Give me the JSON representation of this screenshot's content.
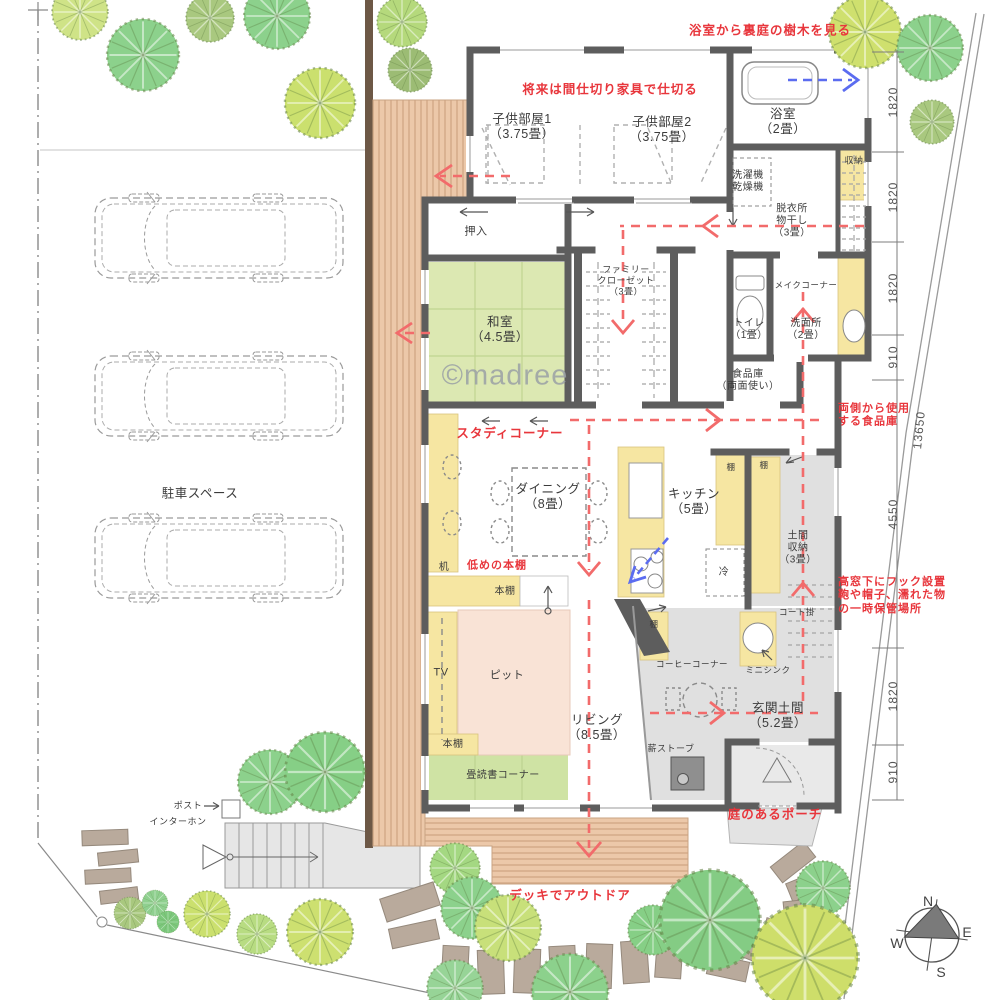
{
  "watermark": "©madree",
  "compass": {
    "n": "N",
    "e": "E",
    "s": "S",
    "w": "W"
  },
  "site": {
    "parking_label": "駐車スペース",
    "post_label": "ポスト",
    "intercom_label": "インターホン"
  },
  "annotations": {
    "bath_view": "浴室から裏庭の樹木を見る",
    "future_partition": "将来は間仕切り家具で仕切る",
    "study_corner": "スタディコーナー",
    "low_bookshelf": "低めの本棚",
    "pantry_both_sides": {
      "line1": "両側から使用",
      "line2": "する食品庫"
    },
    "hooks_note": {
      "line1": "高窓下にフック設置",
      "line2": "鞄や帽子、濡れた物",
      "line3": "の一時保管場所"
    },
    "garden_porch": "庭のあるポーチ",
    "deck_outdoor": "デッキでアウトドア"
  },
  "rooms": {
    "child1": {
      "name": "子供部屋1",
      "size": "（3.75畳）"
    },
    "child2": {
      "name": "子供部屋2",
      "size": "（3.75畳）"
    },
    "bath": {
      "name": "浴室",
      "size": "（2畳）"
    },
    "laundry": {
      "line1": "洗濯機",
      "line2": "乾燥機"
    },
    "dressing": {
      "line1": "脱衣所",
      "line2": "物干し",
      "size": "（3畳）"
    },
    "storage_top": "収納",
    "oshiire": "押入",
    "washitsu": {
      "name": "和室",
      "size": "（4.5畳）"
    },
    "family_closet": {
      "line1": "ファミリー",
      "line2": "クローゼット",
      "size": "（3畳）"
    },
    "toilet": {
      "name": "トイレ",
      "size": "（1畳）"
    },
    "washroom": {
      "name": "洗面所",
      "size": "（2畳）"
    },
    "makeup_corner": "メイクコーナー",
    "pantry": {
      "name": "食品庫",
      "size": "（両面使い）"
    },
    "dining": {
      "name": "ダイニング",
      "size": "（8畳）"
    },
    "kitchen": {
      "name": "キッチン",
      "size": "（5畳）"
    },
    "doma_storage": {
      "line1": "土間",
      "line2": "収納",
      "size": "（3畳）"
    },
    "living": {
      "name": "リビング",
      "size": "（8.5畳）"
    },
    "genkan": {
      "name": "玄関土間",
      "size": "（5.2畳）"
    },
    "tatami_reading": "畳読書コーナー",
    "pit": "ピット",
    "coffee_corner": "コーヒーコーナー",
    "mini_sink": "ミニシンク",
    "coat_rack": "コート掛",
    "wood_stove": "薪ストーブ"
  },
  "fixtures": {
    "tv": "TV",
    "desk": "机",
    "fridge": "冷",
    "shelf": "棚",
    "bookshelf": "本棚"
  },
  "dimensions": {
    "chain": [
      "1820",
      "1820",
      "1820",
      "910",
      "4550",
      "1820",
      "910"
    ],
    "total": "13650"
  },
  "colors": {
    "annotation_red": "#e8363c",
    "flow_red": "#f26b6b",
    "flow_blue": "#5b6cf0",
    "wall": "#5d5d5d",
    "tatami_green": "#dce8b2",
    "pit_pink": "#f9e3d6",
    "counter_yellow": "#f6e6a2",
    "deck_wood": "#ecc8a9"
  }
}
